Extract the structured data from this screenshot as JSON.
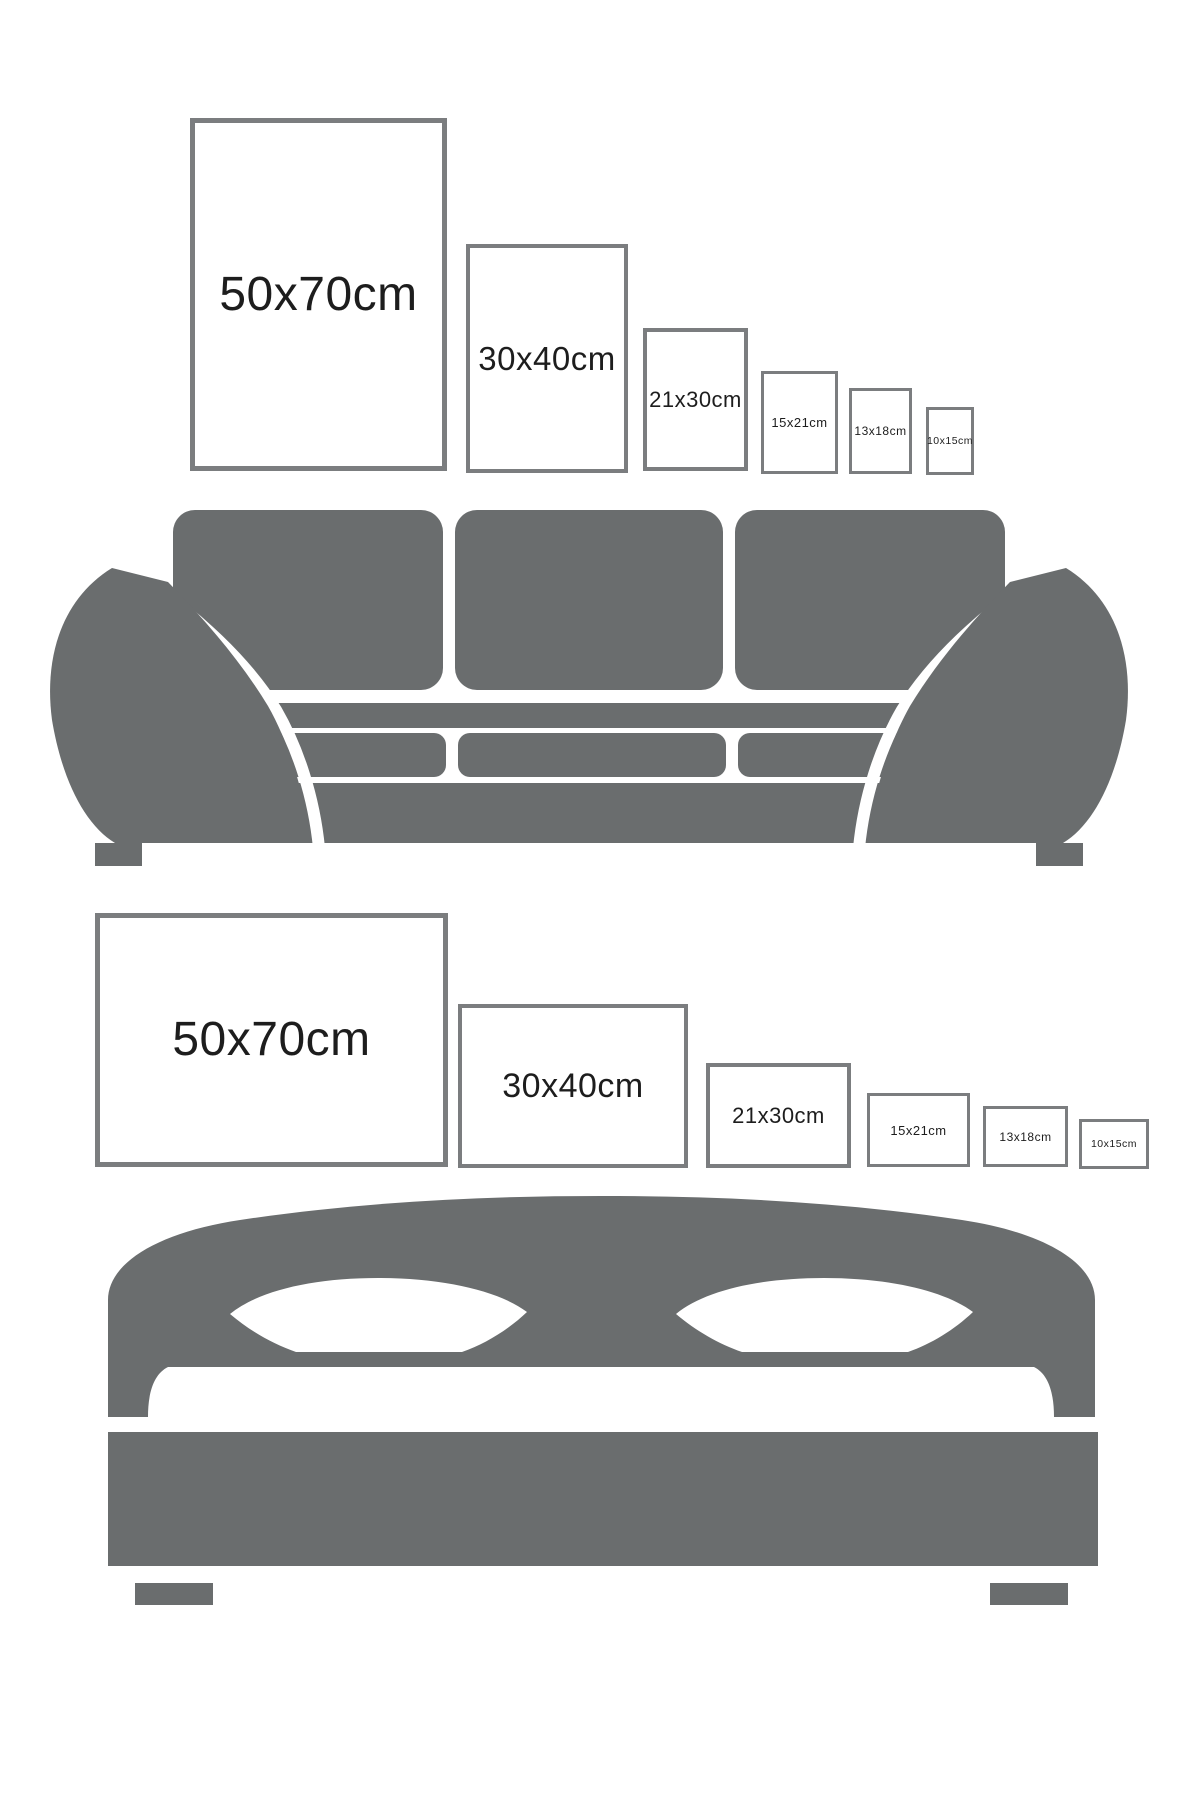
{
  "page": {
    "width": 1200,
    "height": 1800,
    "background": "#ffffff"
  },
  "colors": {
    "furniture_gray": "#6a6d6e",
    "frame_border": "#7b7d7f",
    "label_text": "#1d1d1d"
  },
  "top_section": {
    "description": "poster size comparison above sofa",
    "furniture_icon": "sofa-icon",
    "frames": [
      {
        "label": "50x70cm",
        "orientation": "portrait",
        "x": 190,
        "y": 118,
        "w": 257,
        "h": 353,
        "border_px": 5,
        "font_px": 48
      },
      {
        "label": "30x40cm",
        "orientation": "portrait",
        "x": 466,
        "y": 244,
        "w": 162,
        "h": 229,
        "border_px": 4,
        "font_px": 33
      },
      {
        "label": "21x30cm",
        "orientation": "portrait",
        "x": 643,
        "y": 328,
        "w": 105,
        "h": 143,
        "border_px": 4,
        "font_px": 22
      },
      {
        "label": "15x21cm",
        "orientation": "portrait",
        "x": 761,
        "y": 371,
        "w": 77,
        "h": 103,
        "border_px": 3,
        "font_px": 13
      },
      {
        "label": "13x18cm",
        "orientation": "portrait",
        "x": 849,
        "y": 388,
        "w": 63,
        "h": 86,
        "border_px": 3,
        "font_px": 12
      },
      {
        "label": "10x15cm",
        "orientation": "portrait",
        "x": 926,
        "y": 407,
        "w": 48,
        "h": 68,
        "border_px": 3,
        "font_px": 10.5
      }
    ]
  },
  "bottom_section": {
    "description": "poster size comparison above bed",
    "furniture_icon": "bed-icon",
    "frames": [
      {
        "label": "50x70cm",
        "orientation": "landscape",
        "x": 95,
        "y": 913,
        "w": 353,
        "h": 254,
        "border_px": 5,
        "font_px": 48
      },
      {
        "label": "30x40cm",
        "orientation": "landscape",
        "x": 458,
        "y": 1004,
        "w": 230,
        "h": 164,
        "border_px": 4,
        "font_px": 34
      },
      {
        "label": "21x30cm",
        "orientation": "landscape",
        "x": 706,
        "y": 1063,
        "w": 145,
        "h": 105,
        "border_px": 4,
        "font_px": 22
      },
      {
        "label": "15x21cm",
        "orientation": "landscape",
        "x": 867,
        "y": 1093,
        "w": 103,
        "h": 74,
        "border_px": 3,
        "font_px": 13
      },
      {
        "label": "13x18cm",
        "orientation": "landscape",
        "x": 983,
        "y": 1106,
        "w": 85,
        "h": 61,
        "border_px": 3,
        "font_px": 12
      },
      {
        "label": "10x15cm",
        "orientation": "landscape",
        "x": 1079,
        "y": 1119,
        "w": 70,
        "h": 50,
        "border_px": 3,
        "font_px": 10.5
      }
    ]
  }
}
